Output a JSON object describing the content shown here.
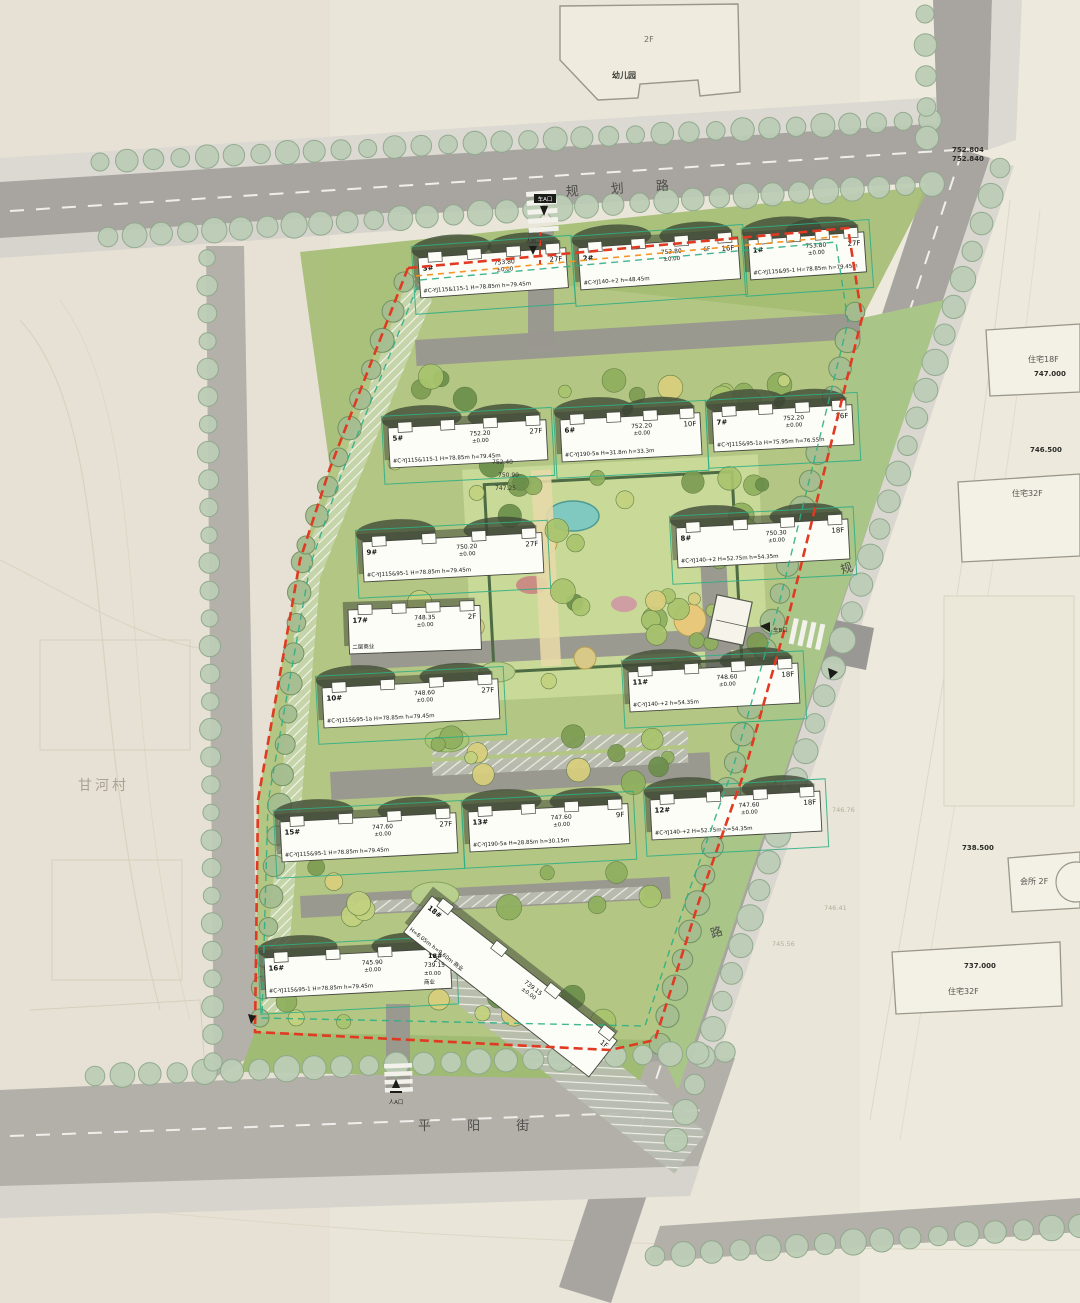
{
  "roads": {
    "top": "规 划 路",
    "bottom": "平 阳 街",
    "right_chars": [
      "规",
      "划",
      "路"
    ]
  },
  "village_label": "甘河村",
  "kindergarten": {
    "name": "幼儿园",
    "floors": "2F"
  },
  "neighbors": [
    "住宅18F",
    "住宅32F",
    "会所 2F",
    "住宅32F"
  ],
  "spot_elevations": [
    "752.804",
    "752.840",
    "747.000",
    "746.500",
    "738.500",
    "737.000",
    "746.76",
    "746.41",
    "745.56"
  ],
  "site_notes": [
    "752.40",
    "750.90",
    "747.25"
  ],
  "datum": "±0.00",
  "entrances": [
    "车A口",
    "人B口",
    "车B口",
    "人A口"
  ],
  "buildings": [
    {
      "id": "3#",
      "floors": "27F",
      "elev": "753.80",
      "code": "#C-YJ115&115-1",
      "dims": "H=78.85m h=79.45m"
    },
    {
      "id": "2#",
      "floors": "16F",
      "elev": "753.80",
      "code": "#C-YJ140-+2",
      "dims": "h=48.45m",
      "podium": "6F"
    },
    {
      "id": "1#",
      "floors": "27F",
      "elev": "753.80",
      "code": "#C-YJ115&95-1",
      "dims": "H=78.85m h=79.45m"
    },
    {
      "id": "5#",
      "floors": "27F",
      "elev": "752.20",
      "code": "#C-YJ115&115-1",
      "dims": "H=78.85m h=79.45m"
    },
    {
      "id": "6#",
      "floors": "10F",
      "elev": "752.20",
      "code": "#C-YJ190-5a",
      "dims": "H=31.8m h=33.3m"
    },
    {
      "id": "7#",
      "floors": "26F",
      "elev": "752.20",
      "code": "#C-YJ115&95-1a",
      "dims": "H=75.95m h=76.55m"
    },
    {
      "id": "9#",
      "floors": "27F",
      "elev": "750.20",
      "code": "#C-YJ115&95-1",
      "dims": "H=78.85m h=79.45m"
    },
    {
      "id": "8#",
      "floors": "18F",
      "elev": "750.30",
      "code": "#C-YJ140-+2",
      "dims": "H=52.75m h=54.35m"
    },
    {
      "id": "17#",
      "floors": "2F",
      "elev": "748.35",
      "code": "",
      "dims": "",
      "note": "二层商业"
    },
    {
      "id": "10#",
      "floors": "27F",
      "elev": "748.60",
      "code": "#C-YJ115&95-1a",
      "dims": "H=78.85m h=79.45m"
    },
    {
      "id": "11#",
      "floors": "18F",
      "elev": "748.60",
      "code": "#C-YJ140-+2",
      "dims": "h=54.35m"
    },
    {
      "id": "15#",
      "floors": "27F",
      "elev": "747.60",
      "code": "#C-YJ115&95-1",
      "dims": "H=78.85m h=79.45m"
    },
    {
      "id": "13#",
      "floors": "9F",
      "elev": "747.60",
      "code": "#C-YJ190-5a",
      "dims": "H=28.85m h=30.15m"
    },
    {
      "id": "12#",
      "floors": "18F",
      "elev": "747.60",
      "code": "#C-YJ140-+2",
      "dims": "H=52.75m h=54.35m"
    },
    {
      "id": "16#",
      "floors": "27F",
      "elev": "745.90",
      "code": "#C-YJ115&95-1",
      "dims": "H=78.85m h=79.45m"
    },
    {
      "id": "18#",
      "floors": "1F",
      "elev": "739.15",
      "code": "",
      "dims": "H=8.05m h=9.60m",
      "note": "商业"
    }
  ],
  "colors": {
    "boundary_red": "#e03a22",
    "fire_lane_green": "#2fae85",
    "orange_dash": "#f59425",
    "road_gray": "#a8a5a0",
    "site_green": "#b3c683",
    "tree_sage": "#b9cbb2"
  }
}
